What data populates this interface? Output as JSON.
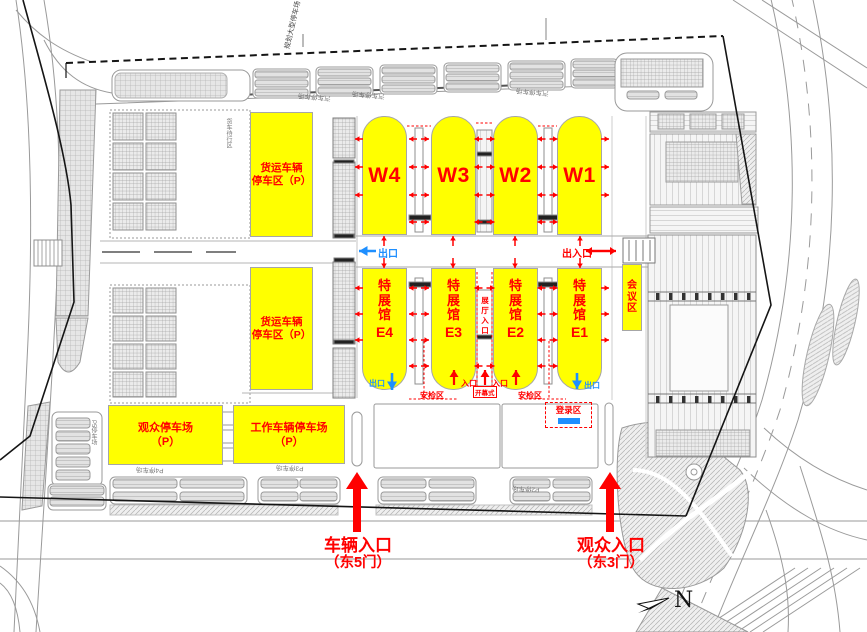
{
  "map": {
    "halls_w": [
      {
        "id": "W4"
      },
      {
        "id": "W3"
      },
      {
        "id": "W2"
      },
      {
        "id": "W1"
      }
    ],
    "halls_e": [
      {
        "name": "特展馆",
        "id": "E4"
      },
      {
        "name": "特展馆",
        "id": "E3"
      },
      {
        "name": "特展馆",
        "id": "E2"
      },
      {
        "name": "特展馆",
        "id": "E1"
      }
    ],
    "zones": {
      "freight_upper": [
        "货运车辆",
        "停车区（P）"
      ],
      "freight_lower": [
        "货运车辆",
        "停车区（P）"
      ],
      "visitor_parking": [
        "观众停车场",
        "（P）"
      ],
      "work_parking": [
        "工作车辆停车场",
        "（P）"
      ],
      "conference": "会议区",
      "hall_lobby_entrance": "展厅入口",
      "registration": "登录区",
      "security_check_left": "安检区",
      "security_check_right": "安检区",
      "opening_ceremony": "开幕式"
    },
    "flows": {
      "exit_mid_left": "出口",
      "exit_entrance_mid_right": "出入口",
      "exit_e4": "出口",
      "exit_e1": "出口",
      "entrance_left": "入口",
      "entrance_right": "入口",
      "vehicle_entrance": "车辆入口",
      "vehicle_entrance_gate": "（东5门）",
      "visitor_entrance": "观众入口",
      "visitor_entrance_gate": "（东3门）"
    },
    "minor_labels": {
      "planned_parking": "规划大型停车场",
      "car_park_top": "汽车停车场",
      "truck_wait_area": "货车待行区",
      "p5": "P5停车场",
      "p4": "P4停车场",
      "p3": "P3停车场",
      "p2": "P2停车场"
    },
    "compass_north": "N",
    "colors": {
      "hall_fill": "#ffff00",
      "accent_red": "#ff0000",
      "accent_blue": "#1e8fff"
    }
  }
}
